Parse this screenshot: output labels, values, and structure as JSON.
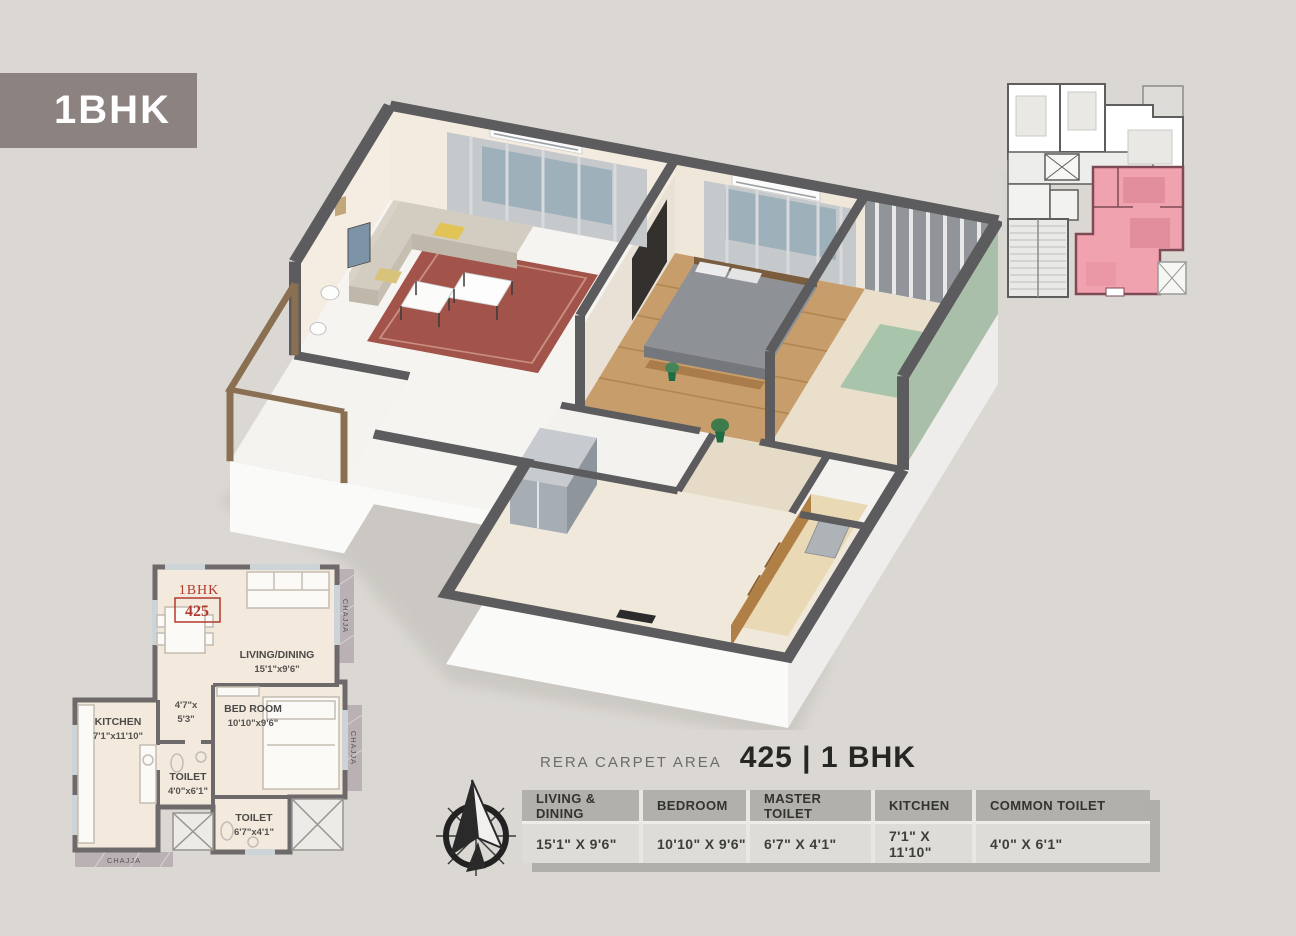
{
  "badge": {
    "label": "1BHK"
  },
  "plan2d": {
    "unit_type": "1BHK",
    "unit_number": "425",
    "rooms": {
      "living": {
        "name": "LIVING/DINING",
        "dims": "15'1\"x9'6\""
      },
      "bedroom": {
        "name": "BED ROOM",
        "dims": "10'10\"x9'6\""
      },
      "kitchen": {
        "name": "KITCHEN",
        "dims": "7'1\"x11'10\""
      },
      "toilet_small": {
        "name": "TOILET",
        "dims": "4'0\"x6'1\""
      },
      "toilet_large": {
        "name": "TOILET",
        "dims": "6'7\"x4'1\""
      },
      "passage": {
        "dims_line1": "4'7\"x",
        "dims_line2": "5'3\""
      }
    },
    "chajja_label": "CHAJJA"
  },
  "rera": {
    "label": "RERA CARPET AREA",
    "value": "425 | 1 BHK"
  },
  "dimensions_table": {
    "headers": [
      "LIVING & DINING",
      "BEDROOM",
      "MASTER TOILET",
      "KITCHEN",
      "COMMON TOILET"
    ],
    "values": [
      "15'1\" X 9'6\"",
      "10'10\" X 9'6\"",
      "6'7\" X 4'1\"",
      "7'1\" X 11'10\"",
      "4'0\" X 6'1\""
    ]
  },
  "colors": {
    "page_bg": "#dbd8d3",
    "badge_bg": "#8c8380",
    "accent_red": "#b33a2e",
    "highlight_pink": "#f0a3ae",
    "wall_dark": "#5c5b5d"
  },
  "icons": {
    "compass": "compass-icon"
  }
}
